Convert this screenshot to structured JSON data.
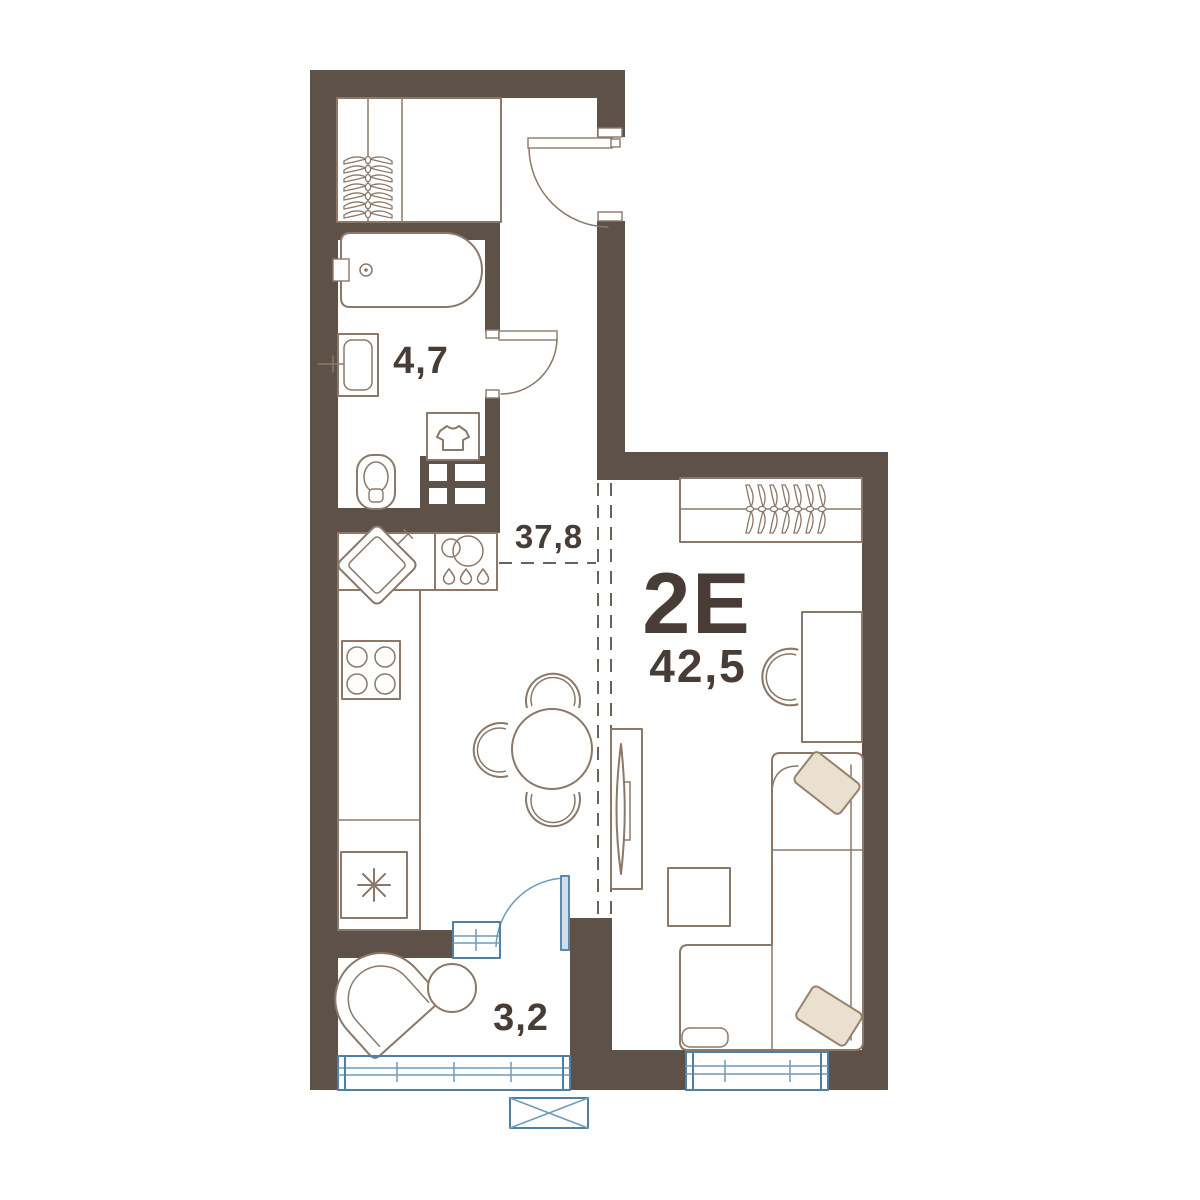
{
  "floorplan": {
    "apartment_type": "2Е",
    "total_area": "42,5",
    "areas": {
      "living_kitchen": "37,8",
      "bathroom": "4,7",
      "loggia": "3,2"
    },
    "colors": {
      "wall": "#5d5148",
      "furniture_line": "#8b7869",
      "window_blue": "#4e80a6",
      "pillow_beige": "#e9e0cf",
      "label_text": "#473c36",
      "background": "#ffffff"
    },
    "rooms": [
      {
        "name": "entry-hall",
        "furniture": [
          "wardrobe-with-hangers",
          "entry-door"
        ]
      },
      {
        "name": "bathroom",
        "furniture": [
          "bathtub",
          "sink",
          "toilet",
          "washing-machine",
          "bathroom-door"
        ]
      },
      {
        "name": "kitchen-living",
        "furniture": [
          "kitchen-sink",
          "dishwasher",
          "stove",
          "fridge",
          "dining-table",
          "dining-chairs",
          "wardrobe-with-hangers",
          "desk",
          "desk-chair",
          "tv-stand",
          "corner-sofa",
          "pillows",
          "coffee-table"
        ]
      },
      {
        "name": "loggia",
        "furniture": [
          "armchair",
          "side-table",
          "balcony-door",
          "glazing"
        ]
      }
    ],
    "symbols": [
      "ventilation-shaft",
      "zone-dashed-line",
      "window",
      "ac-unit"
    ]
  }
}
